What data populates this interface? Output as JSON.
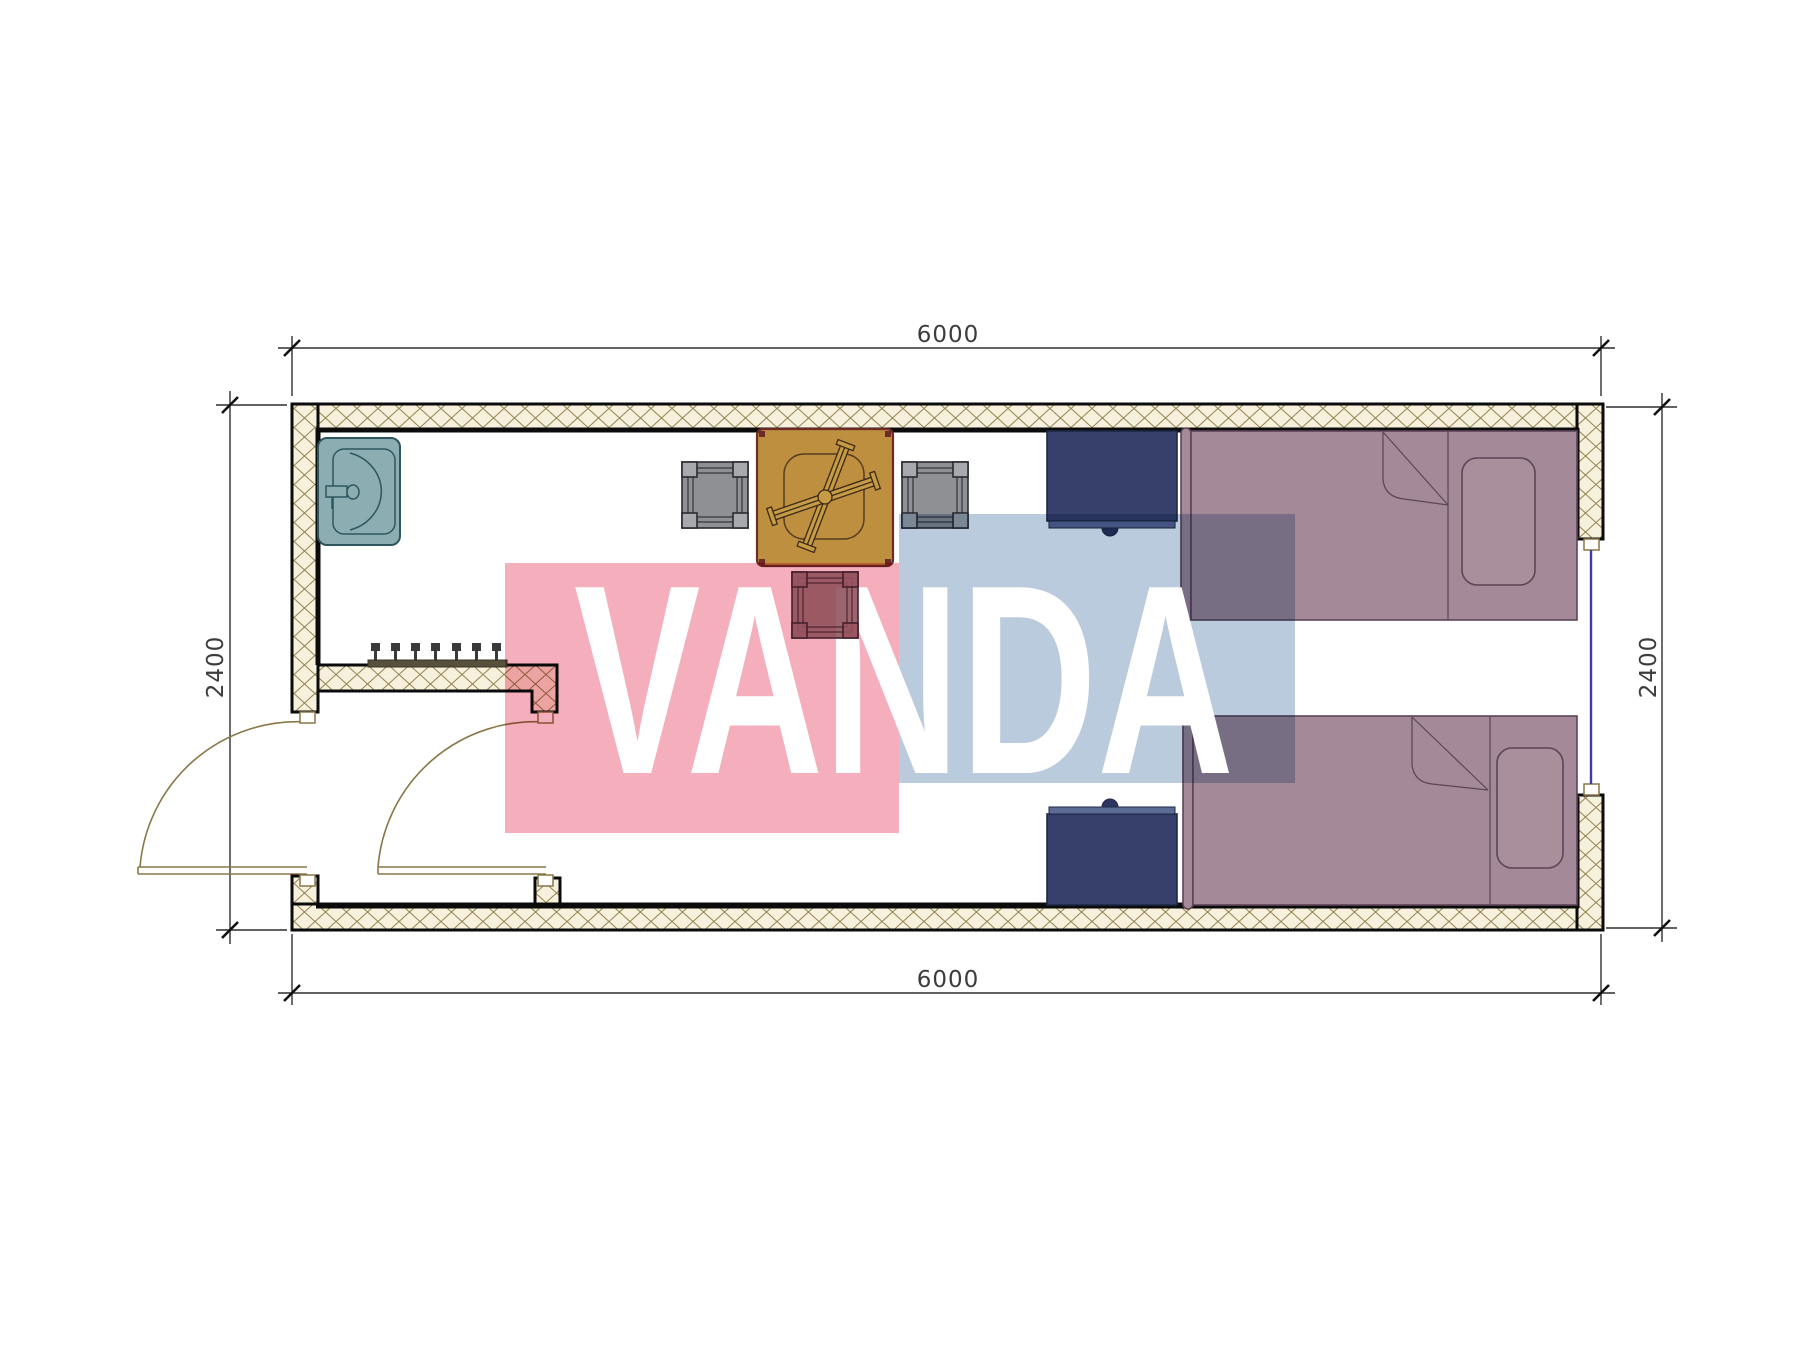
{
  "drawing": {
    "type": "architectural floor plan, 6000 x 2400 container room",
    "dimensions": {
      "top": "6000",
      "bottom": "6000",
      "left": "2400",
      "right": "2400"
    },
    "watermark": {
      "text": "VANDA",
      "pink_color": "#f4aebc",
      "blue_color": "#bacbdd"
    },
    "colors": {
      "wall_hatch_line": "#93824e",
      "wall_fill": "#f6f0dc",
      "wall_border": "#0b0b0b",
      "bed": "#a48a98",
      "nightstand": "#36406a",
      "table": "#bd8f3e",
      "stool_gray": "#8e9094",
      "stool_red": "#8a4a54",
      "sink": "#8cadb2",
      "coat_rack": "#57503a",
      "door_line": "#8a7748",
      "window_glazing": "#3c3cac"
    },
    "furniture": {
      "sink": "wash basin",
      "coat_rack": "wall hook rail (7 hooks)",
      "table": "square table with folded chair on top",
      "stools": [
        "gray stool left",
        "gray stool right",
        "red stool bottom"
      ],
      "nightstands": [
        "nightstand upper",
        "nightstand lower"
      ],
      "beds": [
        "single bed upper",
        "single bed lower"
      ],
      "doors": [
        "exterior door (left wall)",
        "interior door (vestibule)"
      ],
      "window": "window in right wall"
    }
  }
}
